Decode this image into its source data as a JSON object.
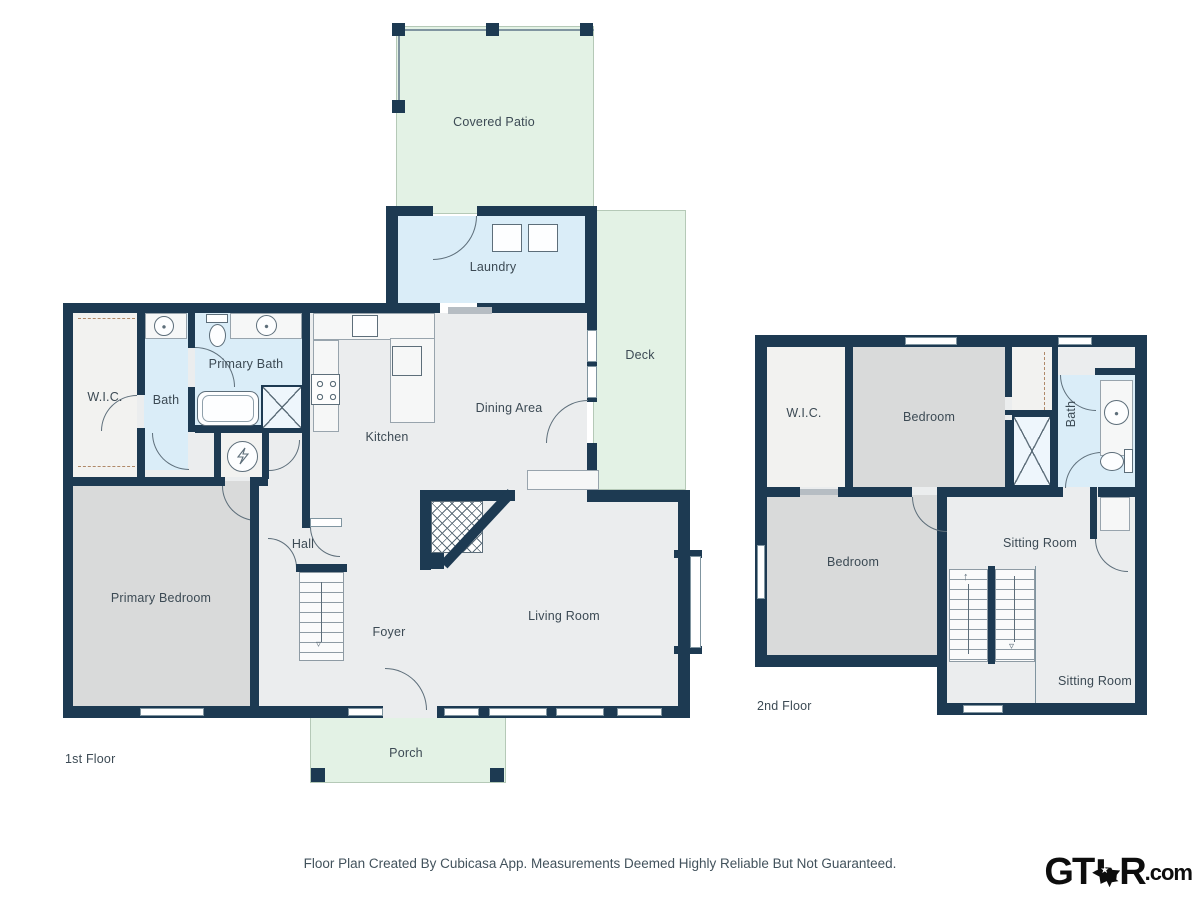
{
  "colors": {
    "wall": "#1d3a52",
    "green": "#e3f2e5",
    "blue": "#daedf8",
    "gray": "#d9dada",
    "light": "#ebedee",
    "lighter": "#f2f2f0",
    "line": "#5d6e7a",
    "winb": "#8095a0",
    "label": "#3c4a54",
    "bar": "#b6bdc3"
  },
  "f1": {
    "floor_label": "1st Floor",
    "patio": "Covered Patio",
    "laundry": "Laundry",
    "deck": "Deck",
    "wic": "W.I.C.",
    "bath": "Bath",
    "primary_bath": "Primary Bath",
    "kitchen": "Kitchen",
    "dining": "Dining Area",
    "hall": "Hall",
    "primary_bedroom": "Primary Bedroom",
    "foyer": "Foyer",
    "living": "Living Room",
    "porch": "Porch"
  },
  "f2": {
    "floor_label": "2nd Floor",
    "wic": "W.I.C.",
    "bedroom_top": "Bedroom",
    "bath": "Bath",
    "bedroom_bottom": "Bedroom",
    "sitting_top": "Sitting Room",
    "sitting_bottom": "Sitting Room"
  },
  "footer": {
    "disclaimer": "Floor Plan Created By Cubicasa App. Measurements Deemed Highly Reliable But Not Guaranteed."
  },
  "logo": {
    "gt": "GT",
    "r": "R",
    "com": ".com",
    "star": "★"
  },
  "icons": {
    "up_arrow": "↑",
    "down_arrow": "▿"
  }
}
